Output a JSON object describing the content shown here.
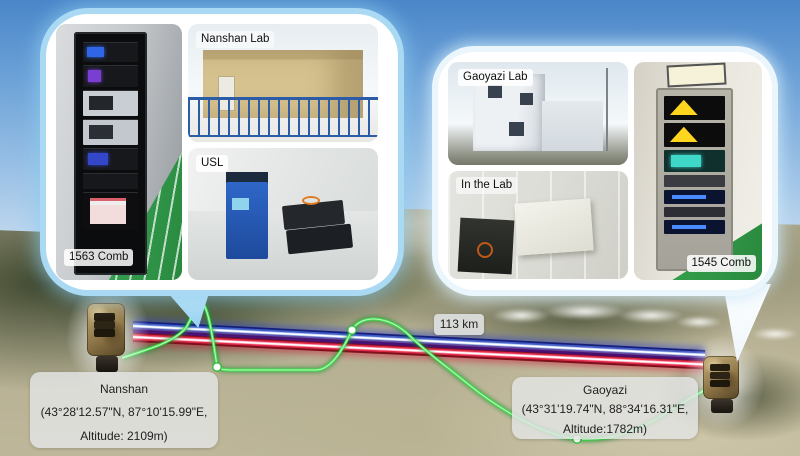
{
  "figure_type": "free-space optical time-frequency link between two sites, photos inset over satellite terrain",
  "link": {
    "distance_label": "113 km"
  },
  "nanshan_bubble": {
    "rack_label": "1563 Comb",
    "lab_label": "Nanshan Lab",
    "usl_label": "USL"
  },
  "gaoyazi_bubble": {
    "rack_label": "1545 Comb",
    "lab_label": "Gaoyazi Lab",
    "inlab_label": "In the Lab"
  },
  "sites": {
    "nanshan": {
      "name": "Nanshan",
      "coords": "(43°28'12.57\"N, 87°10'15.99\"E,",
      "altitude": "Altitude: 2109m)"
    },
    "gaoyazi": {
      "name": "Gaoyazi",
      "coords": "(43°31'19.74\"N, 88°34'16.31\"E,",
      "altitude": "Altitude:1782m)"
    }
  },
  "colors": {
    "beam_blue": "#141f7e",
    "beam_red": "#80101e",
    "fiber_green": "#3ce24a",
    "bubble_border_left": "#a9d9f3",
    "bubble_border_right": "#eaf5fc",
    "sky_top": "#4a86c9"
  }
}
